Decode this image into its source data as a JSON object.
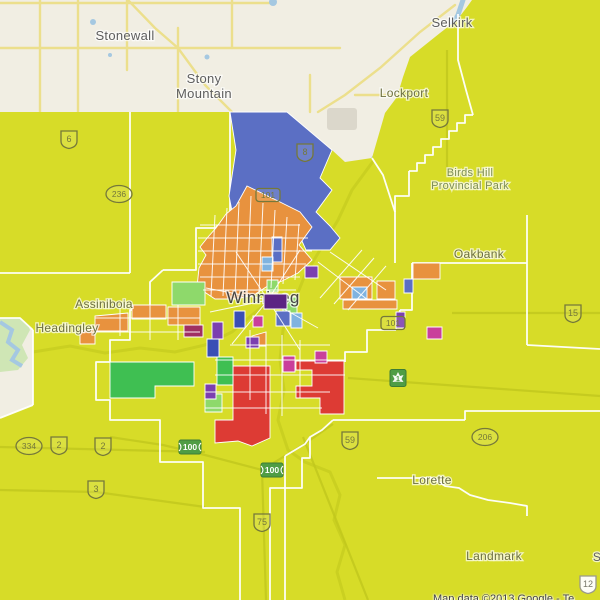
{
  "map": {
    "attribution": "Map data ©2013 Google - Te",
    "city_label": "Winnipeg",
    "colors": {
      "base": "#f1eee3",
      "overlay": "#d7dc28",
      "blue": "#5b6fc4",
      "orange": "#e8923e",
      "red": "#dd3b34",
      "green": "#3fbf52",
      "lightgreen": "#8ed96b",
      "purple": "#7b3fb0",
      "darkpurple": "#5c2483",
      "magenta": "#c93f9b",
      "darkmagenta": "#a02f62",
      "darkblue": "#3a4fb5",
      "lightblue": "#7fb3e0",
      "water": "#a5c8e1",
      "roadYellow": "#ecdf8c",
      "boundary": "#ffffff",
      "street": "#ffffff",
      "olive": "#c2c81d",
      "parkGreen": "#cfe6b5",
      "grayBlob": "#dbd7cb",
      "labelGray": "#5e5e5e",
      "labelOlive": "#6d7040",
      "labelDark": "#454545",
      "parkLabel": "#7d8d55",
      "shieldOlive": "#75783a",
      "shieldGreen": "#4f9d45"
    },
    "places": [
      {
        "id": "stonewall",
        "lines": [
          "Stonewall"
        ],
        "x": 125,
        "y": 40,
        "size": 13,
        "c": "labelGray"
      },
      {
        "id": "stony-mountain",
        "lines": [
          "Stony",
          "Mountain"
        ],
        "x": 204,
        "y": 83,
        "size": 13,
        "c": "labelGray"
      },
      {
        "id": "selkirk",
        "lines": [
          "Selkirk"
        ],
        "x": 452,
        "y": 27,
        "size": 13,
        "c": "labelGray"
      },
      {
        "id": "lockport",
        "lines": [
          "Lockport"
        ],
        "x": 404,
        "y": 97,
        "size": 12,
        "c": "labelOlive"
      },
      {
        "id": "birds-hill-park",
        "lines": [
          "Birds Hill",
          "Provincial Park"
        ],
        "x": 470,
        "y": 176,
        "size": 11,
        "c": "parkLabel"
      },
      {
        "id": "oakbank",
        "lines": [
          "Oakbank"
        ],
        "x": 479,
        "y": 258,
        "size": 12,
        "c": "labelOlive"
      },
      {
        "id": "assiniboia",
        "lines": [
          "Assiniboia"
        ],
        "x": 104,
        "y": 308,
        "size": 12,
        "c": "labelOlive"
      },
      {
        "id": "headingley",
        "lines": [
          "Headingley"
        ],
        "x": 67,
        "y": 332,
        "size": 12,
        "c": "labelOlive"
      },
      {
        "id": "winnipeg",
        "lines": [
          "Winnipeg"
        ],
        "x": 263,
        "y": 303,
        "size": 17,
        "c": "labelDark"
      },
      {
        "id": "lorette",
        "lines": [
          "Lorette"
        ],
        "x": 432,
        "y": 484,
        "size": 12,
        "c": "labelOlive"
      },
      {
        "id": "landmark",
        "lines": [
          "Landmark"
        ],
        "x": 494,
        "y": 560,
        "size": 12,
        "c": "labelOlive"
      },
      {
        "id": "partial-s",
        "lines": [
          "S"
        ],
        "x": 597,
        "y": 561,
        "size": 12,
        "c": "labelGray"
      }
    ],
    "highway_shields": [
      {
        "t": "6",
        "k": "pth",
        "x": 69,
        "y": 139
      },
      {
        "t": "236",
        "k": "oval",
        "x": 119,
        "y": 194
      },
      {
        "t": "8",
        "k": "pth",
        "x": 305,
        "y": 152
      },
      {
        "t": "101",
        "k": "rect",
        "x": 268,
        "y": 195
      },
      {
        "t": "101",
        "k": "rect",
        "x": 393,
        "y": 323
      },
      {
        "t": "59",
        "k": "pth",
        "x": 440,
        "y": 118
      },
      {
        "t": "59",
        "k": "pth",
        "x": 350,
        "y": 440
      },
      {
        "t": "15",
        "k": "pth",
        "x": 573,
        "y": 313
      },
      {
        "t": "334",
        "k": "oval",
        "x": 29,
        "y": 446
      },
      {
        "t": "2",
        "k": "pth",
        "x": 59,
        "y": 445
      },
      {
        "t": "2",
        "k": "pth",
        "x": 103,
        "y": 446
      },
      {
        "t": "3",
        "k": "pth",
        "x": 96,
        "y": 489
      },
      {
        "t": "75",
        "k": "pth",
        "x": 262,
        "y": 522
      },
      {
        "t": "206",
        "k": "oval",
        "x": 485,
        "y": 437
      },
      {
        "t": "100",
        "k": "green",
        "x": 190,
        "y": 447
      },
      {
        "t": "100",
        "k": "green",
        "x": 272,
        "y": 470
      },
      {
        "t": "1",
        "k": "tch",
        "x": 398,
        "y": 378
      },
      {
        "t": "12",
        "k": "pth-beige",
        "x": 588,
        "y": 584
      }
    ],
    "geometry": {
      "overlay_poly": "0,112 230,112 287,112 332,150 345,162 372,158 385,113 397,97 403,77 410,57 440,33 457,20 467,7 472,0 600,0 600,600 527,600 527,516 600,516 600,600 527,600 527,516 527,600 0,600 0,418 33,405 33,330 20,318 0,318",
      "overlay_main": "0,112 230,112 287,112 332,150 345,162 372,158 385,113 397,97 403,77 410,57 440,33 457,20 467,7 472,0 600,0 600,600 527,600 527,516 527,505 510,503 488,500 470,495 459,488 445,486 433,478 377,478 377,600 0,600 0,418 33,405 33,330 20,318 0,318",
      "overlay_patch": "377,478 433,478 445,486 459,488 470,495 488,500 510,503 527,506 527,600 377,600",
      "beige_roads": [
        "0,48 340,48",
        "0,3 270,3",
        "40,0 40,112",
        "78,0 78,112",
        "127,0 127,70",
        "178,28 178,112",
        "232,0 232,48",
        "310,75 310,112",
        "128,0 155,28 178,48",
        "178,48 205,85 232,112",
        "455,5 420,32 380,68 345,95 318,112",
        "355,95 430,95",
        "530,560 600,543",
        "585,516 585,600",
        "540,600 580,565"
      ],
      "river": "463,0 458,15 448,32 436,48 430,62 424,78 418,92 412,104 402,122 392,138 383,150 374,158",
      "left_river": "0,322 12,330 8,342 18,350 12,360 22,366",
      "park_blob": "0,315 25,318 30,330 22,345 28,358 18,370 0,372",
      "ponds": [
        [
          93,
          22,
          3
        ],
        [
          273,
          2,
          4
        ],
        [
          207,
          57,
          2.5
        ],
        [
          110,
          55,
          2
        ]
      ],
      "gray_blob": [
        327,
        108,
        30,
        22
      ],
      "olive_roads": [
        "447,50 447,170",
        "452,313 600,313",
        "348,378 600,396",
        "303,437 368,600",
        "262,470 266,600",
        "0,447 205,452",
        "0,490 96,492 205,507",
        "110,437 163,445 205,455 262,470 303,445 333,424"
      ],
      "rivers_olive": [
        "374,160 352,190 338,220 320,250 305,275 295,300",
        "295,300 283,330 280,360 284,390 278,420 288,450 305,462 330,472 340,495 334,520 345,545 337,572 345,600",
        "33,352 70,346 105,353 140,348 175,352 205,345 232,332 252,315 268,302"
      ],
      "boundaries": [
        "130,112 130,273",
        "0,273 130,273",
        "33,330 33,405",
        "33,405 0,418",
        "0,318 20,318 33,330",
        "458,14 458,60 466,90 473,115",
        "473,115 465,115 465,123 457,123 457,131 449,131 449,139 441,139 441,147 433,147 433,155 425,155 425,163 417,163 417,171 409,171",
        "409,171 409,196 395,196 395,212",
        "412,263 527,263",
        "412,263 412,310 400,310",
        "527,215 527,345",
        "527,345 600,349",
        "333,420 465,420",
        "465,420 465,411 600,411",
        "377,478 433,478 445,486 459,488 470,495 488,500 510,503 527,506 527,516",
        "285,456 285,600",
        "333,420 322,430 310,437 305,444 295,450 285,456",
        "160,437 160,462 203,462 203,508 240,508 240,600",
        "310,437 310,458 302,458 302,488 270,488 270,600",
        "163,270 150,282 150,310 130,310 130,340 110,340 110,362 96,362 96,400 110,400 110,420 160,420 160,437",
        "163,270 196,270 196,228 215,228 230,215 230,112",
        "372,158 383,175 395,212 395,263",
        "396,330 400,310",
        "396,330 367,330 367,352 345,352 345,362"
      ],
      "regions": [
        {
          "n": "blue-north",
          "f": "blue",
          "p": "230,112 287,112 332,150 320,178 332,190 316,212 330,226 340,238 330,250 306,250 298,232 285,222 271,232 256,226 244,234 235,226 229,196 236,150"
        },
        {
          "n": "orange-cluster",
          "f": "orange",
          "p": "247,186 276,200 300,212 312,227 299,245 312,260 298,273 282,281 266,287 254,295 236,299 215,299 197,287 199,268 206,255 200,247 208,237 216,228 226,214 236,206"
        },
        {
          "n": "orange-sw1",
          "f": "orange",
          "p": "95,316 128,313 128,331 95,331"
        },
        {
          "n": "orange-sw2",
          "f": "orange",
          "p": "132,305 166,305 166,319 132,319"
        },
        {
          "n": "orange-sw3",
          "f": "orange",
          "p": "168,307 200,307 200,325 168,325"
        },
        {
          "n": "orange-sw4",
          "f": "orange",
          "p": "80,331 95,329 95,344 80,344"
        },
        {
          "n": "orange-tri",
          "f": "orange",
          "p": "252,336 266,332 266,346 252,346"
        },
        {
          "n": "orange-e1",
          "f": "orange",
          "p": "340,277 372,277 372,299 340,299"
        },
        {
          "n": "orange-e2",
          "f": "orange",
          "p": "377,281 395,281 395,299 377,299"
        },
        {
          "n": "orange-bar",
          "f": "orange",
          "p": "343,300 397,300 397,309 343,309"
        },
        {
          "n": "orange-e3",
          "f": "orange",
          "p": "413,263 440,263 440,279 413,279"
        },
        {
          "n": "red-se",
          "f": "red",
          "p": "296,361 344,361 344,414 320,414 320,398 296,398 296,386 312,386 312,370 296,370"
        },
        {
          "n": "red-sw",
          "f": "red",
          "p": "233,366 270,366 270,438 252,446 238,441 215,443 215,420 233,420"
        },
        {
          "n": "green-west",
          "f": "green",
          "p": "110,362 194,362 194,386 155,386 155,398 110,398"
        },
        {
          "n": "green-mid",
          "f": "green",
          "p": "217,357 233,357 233,385 217,385"
        },
        {
          "n": "lightgreen-assiniboia",
          "f": "lightgreen",
          "p": "172,282 205,282 205,305 172,305"
        },
        {
          "n": "lightgreen-1",
          "f": "lightgreen",
          "p": "267,280 278,280 278,292 267,292"
        },
        {
          "n": "lightgreen-2",
          "f": "lightgreen",
          "p": "283,297 297,297 297,313 283,313"
        },
        {
          "n": "lightgreen-3",
          "f": "lightgreen",
          "p": "205,394 222,394 222,412 205,412"
        },
        {
          "n": "purple-1",
          "f": "purple",
          "p": "305,266 318,266 318,278 305,278"
        },
        {
          "n": "purple-2",
          "f": "purple",
          "p": "396,312 405,312 405,328 396,328"
        },
        {
          "n": "purple-3",
          "f": "purple",
          "p": "212,322 223,322 223,339 212,339"
        },
        {
          "n": "purple-4",
          "f": "purple",
          "p": "246,337 259,337 259,348 246,348"
        },
        {
          "n": "purple-5",
          "f": "purple",
          "p": "205,384 216,384 216,399 205,399"
        },
        {
          "n": "darkmagenta-1",
          "f": "darkmagenta",
          "p": "184,325 203,325 203,337 184,337"
        },
        {
          "n": "darkblue-1",
          "f": "darkblue",
          "p": "207,339 219,339 219,357 207,357"
        },
        {
          "n": "darkblue-2",
          "f": "darkblue",
          "p": "234,311 245,311 245,328 234,328"
        },
        {
          "n": "blue-strip",
          "f": "blue",
          "p": "272,237 282,237 282,262 272,262"
        },
        {
          "n": "blue-4",
          "f": "blue",
          "p": "404,279 413,279 413,293 404,293"
        },
        {
          "n": "blue-5",
          "f": "blue",
          "p": "276,311 290,311 290,326 276,326"
        },
        {
          "n": "lightblue-1",
          "f": "lightblue",
          "p": "262,257 273,257 273,271 262,271"
        },
        {
          "n": "lightblue-2",
          "f": "lightblue",
          "p": "291,313 302,313 302,328 291,328"
        },
        {
          "n": "lightblue-3",
          "f": "lightblue",
          "p": "352,287 367,287 367,299 352,299"
        },
        {
          "n": "magenta-1",
          "f": "magenta",
          "p": "315,351 327,351 327,363 315,363"
        },
        {
          "n": "magenta-2",
          "f": "magenta",
          "p": "427,327 442,327 442,339 427,339"
        },
        {
          "n": "magenta-3",
          "f": "magenta",
          "p": "253,316 263,316 263,327 253,327"
        },
        {
          "n": "magenta-4",
          "f": "magenta",
          "p": "283,356 295,356 295,372 283,372"
        }
      ],
      "region_above_label": {
        "n": "darkpurple-core",
        "f": "darkpurple",
        "p": "264,294 287,294 287,309 264,309"
      },
      "streets": [
        "200,225 300,225",
        "198,238 308,238",
        "198,251 312,251",
        "198,264 306,264",
        "200,277 300,277",
        "203,290 296,290",
        "215,215 211,296",
        "227,208 223,296",
        "239,202 235,296",
        "251,196 247,296",
        "263,203 259,293",
        "275,210 271,288",
        "287,217 283,284",
        "299,224 295,280",
        "320,298 362,250",
        "334,304 374,258",
        "348,310 386,266",
        "318,262 368,300",
        "330,252 386,290",
        "268,300 236,252",
        "268,300 300,250",
        "268,300 318,328",
        "268,300 210,312",
        "268,300 232,344",
        "268,300 300,350",
        "268,300 206,288",
        "250,330 250,400",
        "266,332 266,414",
        "282,335 282,416",
        "300,340 300,398",
        "230,345 330,345",
        "215,360 345,360",
        "215,375 345,375",
        "205,392 330,392",
        "205,408 322,408",
        "95,318 200,318",
        "80,332 200,332",
        "120,305 120,336",
        "150,303 150,340",
        "178,305 178,340"
      ]
    }
  }
}
